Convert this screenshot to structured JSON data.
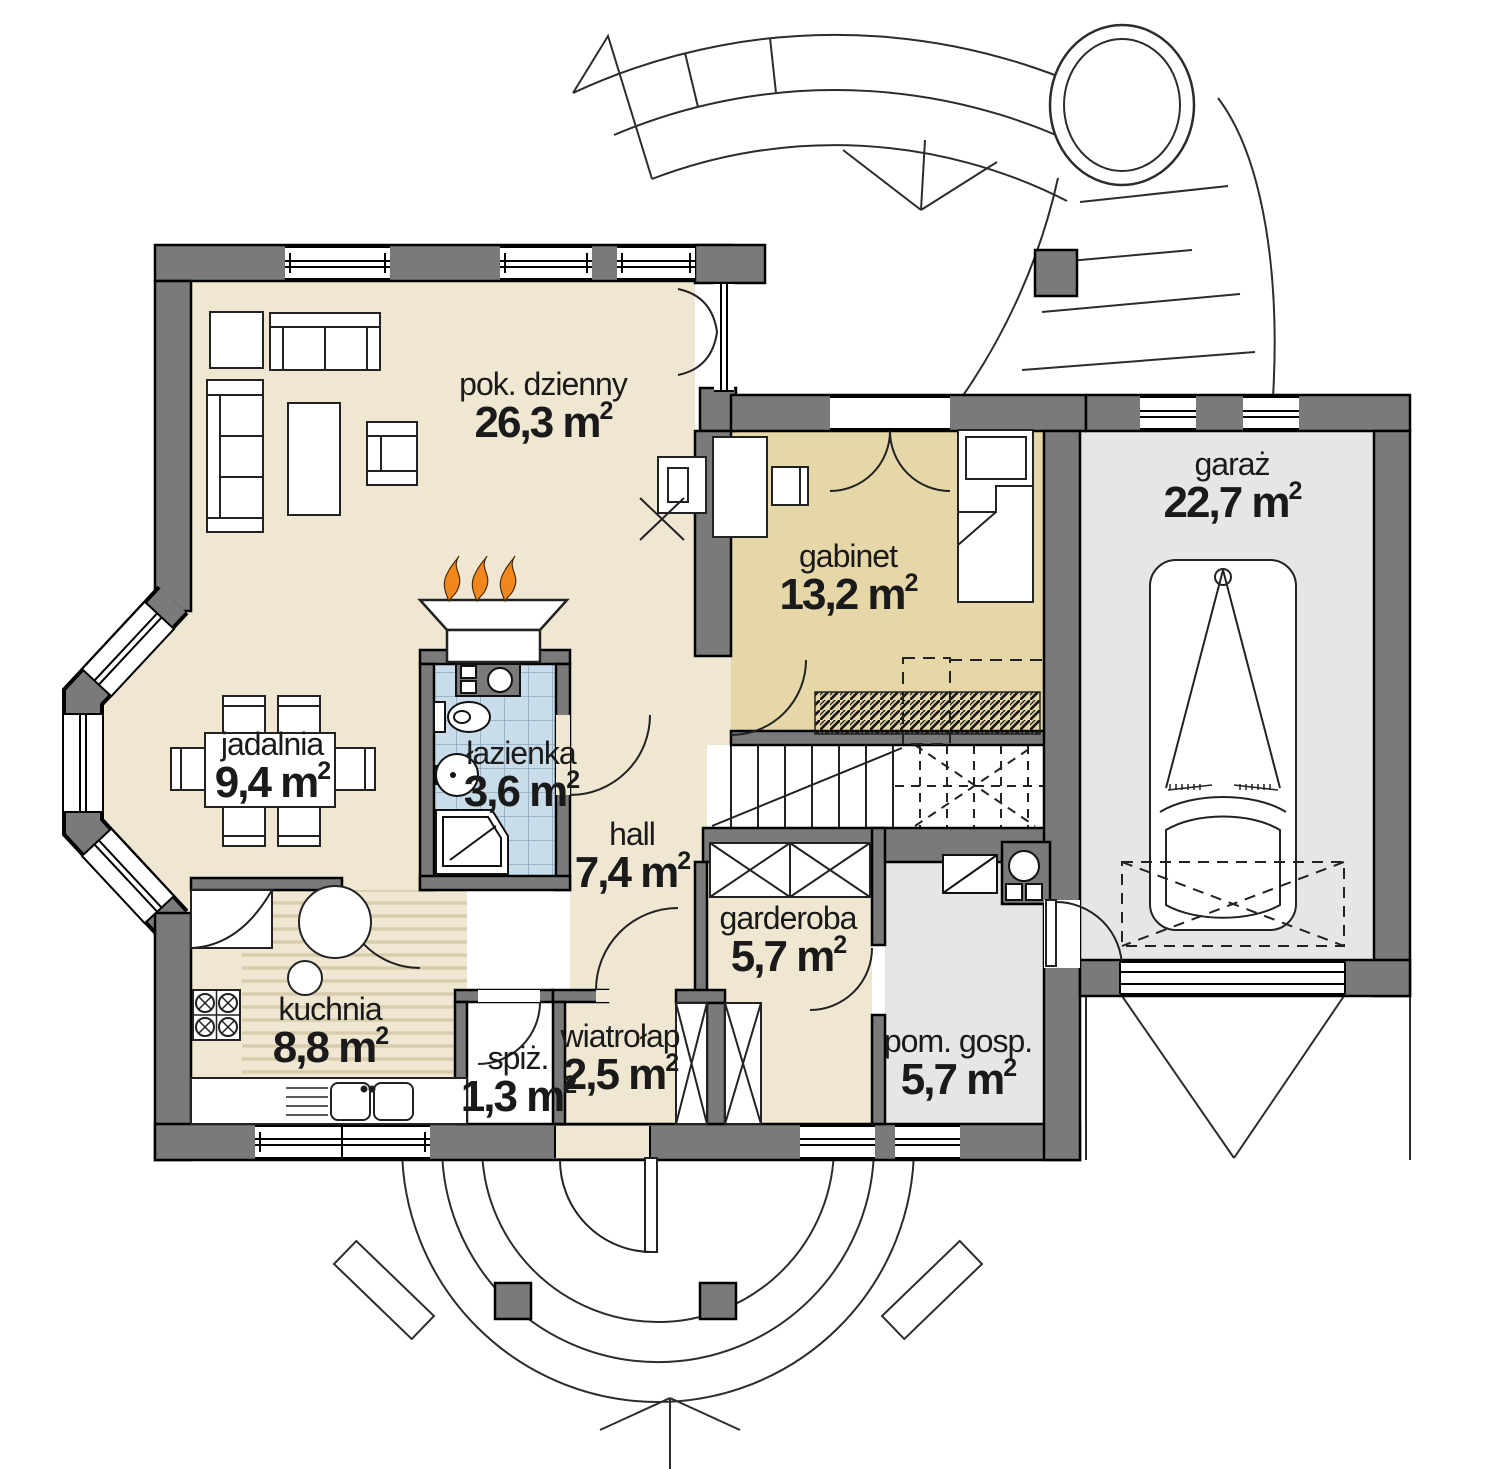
{
  "colors": {
    "wall": "#7A7A7A",
    "floor_cream": "#EFE7D1",
    "floor_tan": "#E5D7A8",
    "floor_gray": "#E6E6E6",
    "tile_blue": "#C9DCE9",
    "tile_line": "#8FA7BC",
    "stripe": "#D8CCAC",
    "flame_orange": "#F0861C",
    "line_dark": "#1a1a1a"
  },
  "rooms": {
    "pok_dzienny": {
      "name": "pok. dzienny",
      "area": "26,3 m",
      "sup": "2"
    },
    "gabinet": {
      "name": "gabinet",
      "area": "13,2 m",
      "sup": "2"
    },
    "garaz": {
      "name": "garaż",
      "area": "22,7 m",
      "sup": "2"
    },
    "jadalnia": {
      "name": "jadalnia",
      "area": "9,4 m",
      "sup": "2"
    },
    "lazienka": {
      "name": "łazienka",
      "area": "3,6 m",
      "sup": "2"
    },
    "hall": {
      "name": "hall",
      "area": "7,4 m",
      "sup": "2"
    },
    "garderoba": {
      "name": "garderoba",
      "area": "5,7 m",
      "sup": "2"
    },
    "kuchnia": {
      "name": "kuchnia",
      "area": "8,8 m",
      "sup": "2"
    },
    "spiz": {
      "name": "spiż.",
      "area": "1,3 m",
      "sup": "2"
    },
    "wiatrolap": {
      "name": "wiatrołap",
      "area": "2,5 m",
      "sup": "2"
    },
    "pom_gosp": {
      "name": "pom. gosp.",
      "area": "5,7 m",
      "sup": "2"
    }
  }
}
